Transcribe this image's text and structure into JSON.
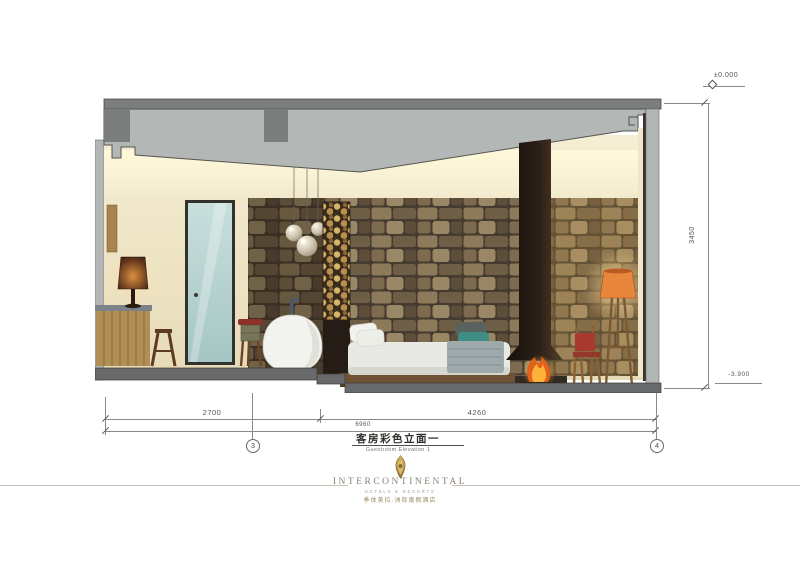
{
  "drawing": {
    "title_cn": "客房彩色立面一",
    "title_en": "Guestroom Elevation 1",
    "levels": {
      "top": "±0.000",
      "bottom": "-3.900"
    },
    "dims": {
      "height": "3450",
      "seg1": "2700",
      "seg2": "4260",
      "total": "6960"
    },
    "grids": {
      "g3": "3",
      "g4": "4"
    },
    "colors": {
      "slab_dark": "#7c7e7d",
      "ceiling_gray": "#b3b7b6",
      "wall_cream": "#efe6c8",
      "stone_brown": "#6f5e46",
      "firewood_tan": "#c8a158",
      "flue_dark": "#2e2118",
      "fire_orange": "#f2801f",
      "glass_blue": "#b9d6d4",
      "accent_teal": "#3f8e86",
      "wood": "#b08f56",
      "lamp_glow": "#e8863c",
      "floor_gray": "#67696a"
    }
  },
  "logo": {
    "brand": "INTERCONTINENTAL",
    "tagline": "HOTELS & RESORTS",
    "brand_cn": "季体美拉·洲际度假酒店"
  }
}
